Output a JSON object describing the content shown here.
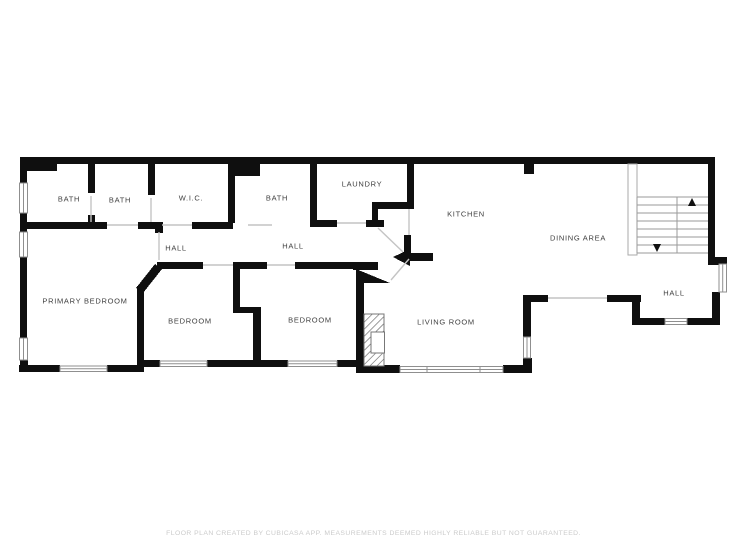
{
  "floorplan": {
    "rooms": [
      {
        "label": "BATH"
      },
      {
        "label": "BATH"
      },
      {
        "label": "W.I.C."
      },
      {
        "label": "BATH"
      },
      {
        "label": "LAUNDRY"
      },
      {
        "label": "HALL"
      },
      {
        "label": "HALL"
      },
      {
        "label": "KITCHEN"
      },
      {
        "label": "DINING AREA"
      },
      {
        "label": "PRIMARY BEDROOM"
      },
      {
        "label": "BEDROOM"
      },
      {
        "label": "BEDROOM"
      },
      {
        "label": "LIVING ROOM"
      },
      {
        "label": "HALL"
      }
    ],
    "icons": {
      "stairs_up": "up-arrow",
      "stairs_down": "down-arrow"
    }
  },
  "footer": {
    "disclaimer": "FLOOR PLAN CREATED BY CUBICASA APP. MEASUREMENTS DEEMED HIGHLY RELIABLE BUT NOT GUARANTEED."
  },
  "colors": {
    "wall": "#0f0f0f",
    "label_text": "#3f3f3f",
    "window_stroke": "#8f8f8f",
    "stair_stroke": "#9a9a9a",
    "door_line": "#c4c4c4",
    "disclaimer_text": "#cbcbcb",
    "background": "#ffffff"
  }
}
